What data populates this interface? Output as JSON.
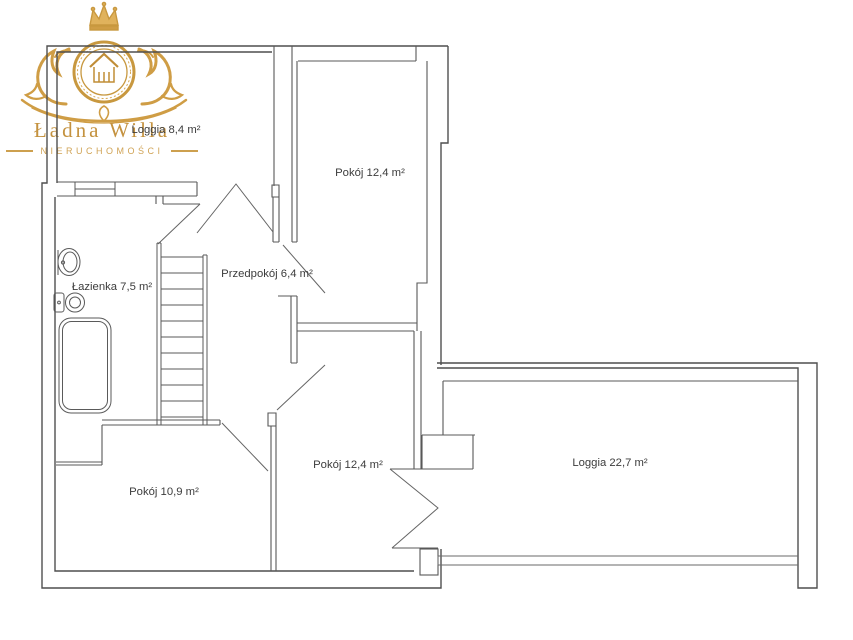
{
  "logo": {
    "brand_name": "Ładna Willa",
    "brand_subtitle": "NIERUCHOMOŚCI",
    "gold": "#c8983f",
    "gold_light": "#daa94e",
    "emblem_icons": [
      "crown-icon",
      "house-icon",
      "lion-left-icon",
      "lion-right-icon",
      "laurel-flourish"
    ]
  },
  "floor_plan": {
    "line_color": "#565656",
    "exterior_line_color": "#4f4f4f",
    "label_color": "#3c3c3c",
    "rooms": [
      {
        "id": "loggia-small",
        "label": "Loggia 8,4 m²"
      },
      {
        "id": "pokoj-top",
        "label": "Pokój 12,4 m²"
      },
      {
        "id": "przedpokoj",
        "label": "Przedpokój 6,4 m²"
      },
      {
        "id": "lazienka",
        "label": "Łazienka 7,5 m²"
      },
      {
        "id": "pokoj-left",
        "label": "Pokój 10,9 m²"
      },
      {
        "id": "pokoj-bottom",
        "label": "Pokój 12,4 m²"
      },
      {
        "id": "loggia-large",
        "label": "Loggia 22,7 m²"
      }
    ],
    "fixtures": [
      "stairs",
      "bathtub",
      "toilet",
      "sink",
      "door-swing",
      "french-door",
      "balcony-railing",
      "window"
    ]
  }
}
